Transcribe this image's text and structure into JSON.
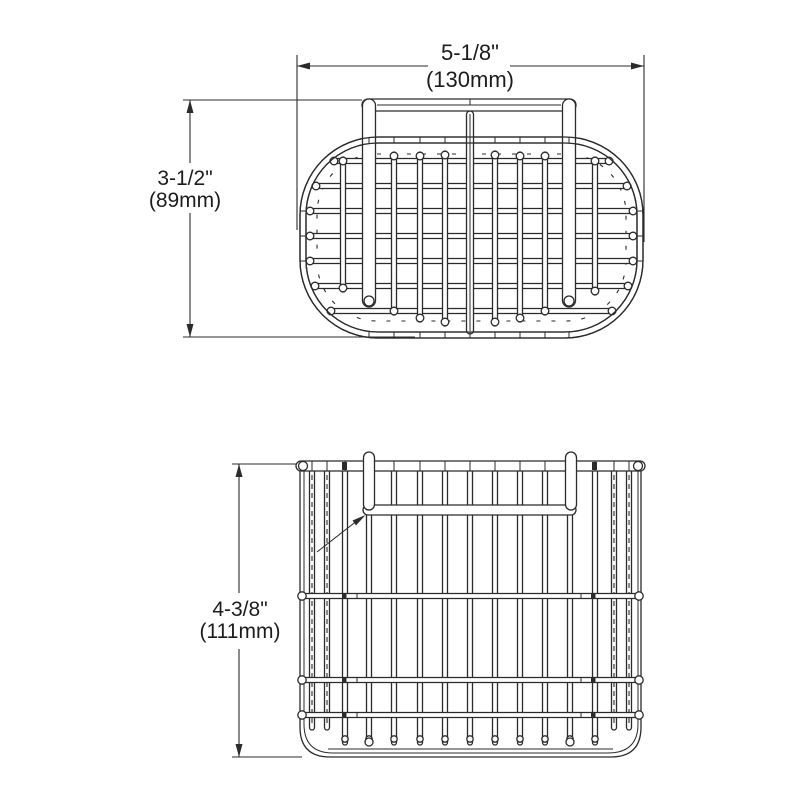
{
  "page": {
    "background": "#ffffff",
    "line_color": "#2b2b2b",
    "text_color": "#1c1c1c"
  },
  "drawing": {
    "type": "technical-drawing",
    "subject": "wire rinsing basket with swing handle",
    "views": {
      "top_view": "basket top view with wire grid and handle",
      "front_view": "basket front elevation with wire grid and handle"
    },
    "dimensions": {
      "width": {
        "inches": "5-1/8\"",
        "mm": "(130mm)"
      },
      "depth": {
        "inches": "3-1/2\"",
        "mm": "(89mm)"
      },
      "height": {
        "inches": "4-3/8\"",
        "mm": "(111mm)"
      }
    }
  }
}
